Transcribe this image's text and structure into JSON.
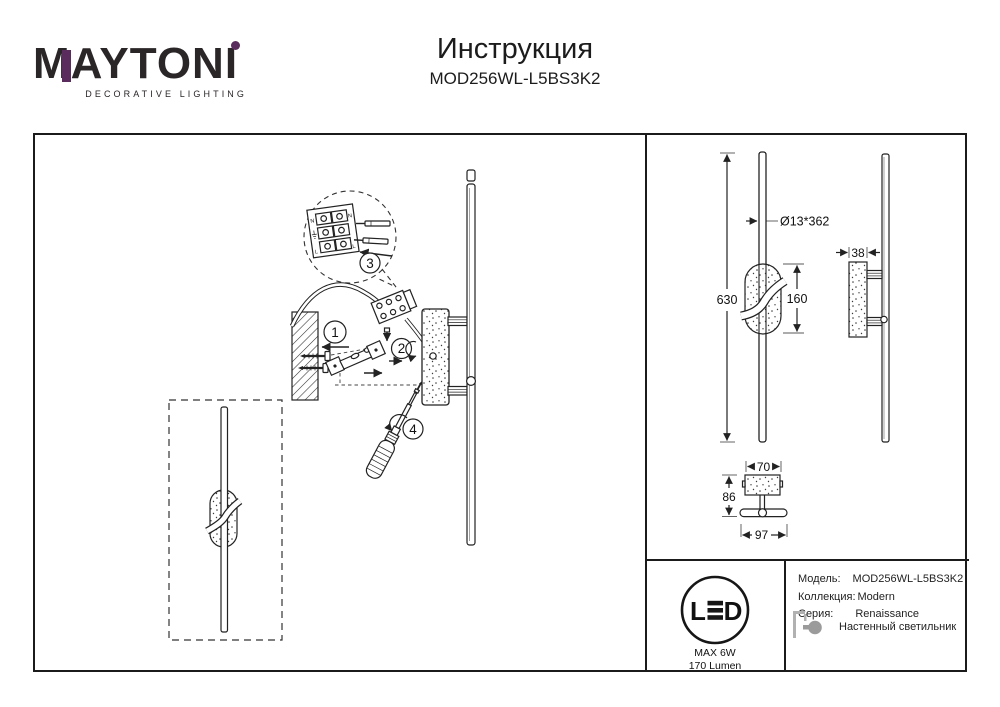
{
  "header": {
    "logo_text": "MAYTONI",
    "logo_subtitle": "DECORATIVE LIGHTING",
    "title": "Инструкция",
    "model": "MOD256WL-L5BS3K2"
  },
  "colors": {
    "accent_purple": "#5a2c5d",
    "line": "#222222",
    "icon_gray": "#a3a3a3"
  },
  "installation": {
    "steps": [
      "1",
      "2",
      "3",
      "4"
    ],
    "terminal": {
      "n": "N",
      "l": "L"
    }
  },
  "dimensions": {
    "total_height": "630",
    "tube": "Ø13*362",
    "shade_height": "160",
    "depth": "38",
    "plate_width": "70",
    "total_depth": "86",
    "total_width": "97"
  },
  "led_badge": {
    "letter_l": "L",
    "e_icon": "three-bars",
    "letter_d": "D",
    "max_power": "MAX 6W",
    "luminous_flux": "170 Lumen"
  },
  "spec": {
    "rows": [
      {
        "label": "Модель:",
        "value": "MOD256WL-L5BS3K2"
      },
      {
        "label": "Коллекция:",
        "value": "Modern"
      },
      {
        "label": "Серия:",
        "value": "Renaissance"
      },
      {
        "label": "",
        "value": "Настенный светильник"
      }
    ]
  }
}
